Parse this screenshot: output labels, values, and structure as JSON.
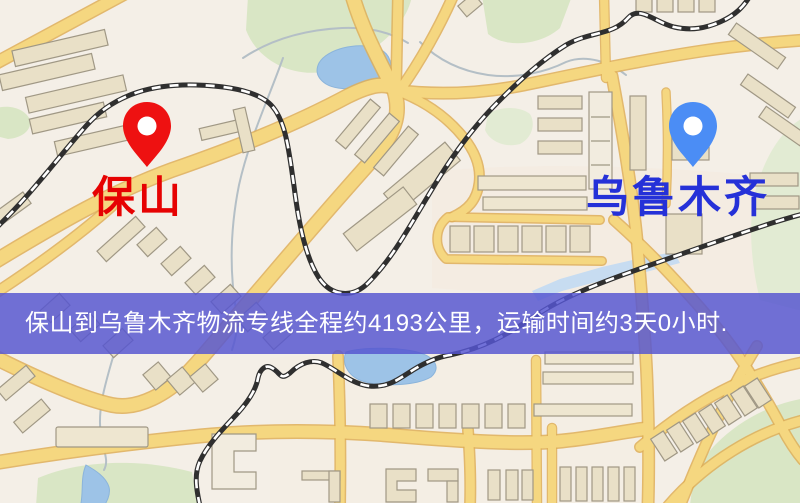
{
  "route_banner": {
    "text": "保山到乌鲁木齐物流专线全程约4193公里，运输时间约3天0小时.",
    "origin": "保山",
    "destination": "乌鲁木齐",
    "distance": "4193公里",
    "duration": "3天0小时",
    "background_color": "#5656d0",
    "text_color": "#ffffff"
  },
  "markers": {
    "origin": {
      "label": "保山",
      "label_color": "#e60202",
      "pin_color": "#ee1111",
      "pin_icon": "map-pin"
    },
    "destination": {
      "label": "乌鲁木齐",
      "label_color": "#2531d8",
      "pin_color": "#4b8df5",
      "pin_icon": "map-pin"
    }
  },
  "map_palette": {
    "land": "#f4efe7",
    "road_fill": "#f6d77d",
    "road_border": "#dfae55",
    "water": "#9cc3e8",
    "park": "#d9e6c4",
    "building": "#e9e0c6",
    "railway": "#2f2f2f"
  }
}
